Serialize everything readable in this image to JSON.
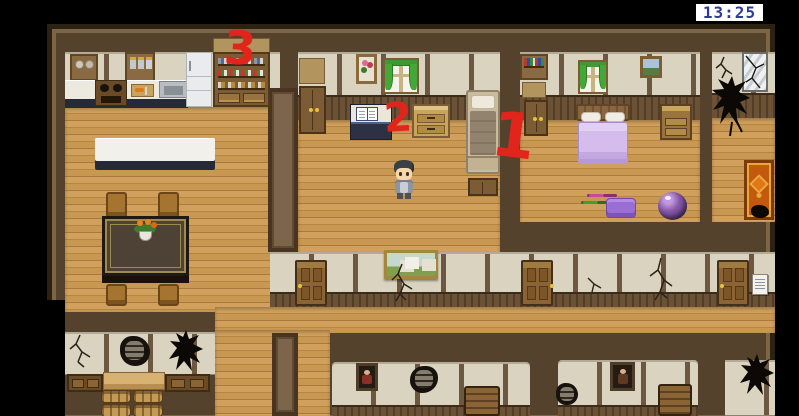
{
  "hud": {
    "clock_time": "13:25",
    "clock_digit_color": "#2d3a9e",
    "clock_bg": "#ffffff"
  },
  "annotations": {
    "marker_color": "#e2251c",
    "markers": [
      {
        "label": "1",
        "points_to": "plain-bed-study-bedroom"
      },
      {
        "label": "2",
        "points_to": "study-desk-with-open-book"
      },
      {
        "label": "3",
        "points_to": "kitchen-dish-shelf"
      }
    ]
  },
  "palette": {
    "floor_wood": "#c89751",
    "wall_brown": "#55422d",
    "wall_panel_cream": "#d9d3c0",
    "bed_purple": "#d4bcec",
    "background": "#000000"
  },
  "scene": {
    "setting": "top-down rpg house interior with damaged lower rooms",
    "character": "boy-sprite-facing-down",
    "rooms": [
      "kitchen-dining-room",
      "study-bedroom",
      "purple-bedroom",
      "damaged-room",
      "hallway",
      "storage-room",
      "ruined-rooms"
    ]
  }
}
